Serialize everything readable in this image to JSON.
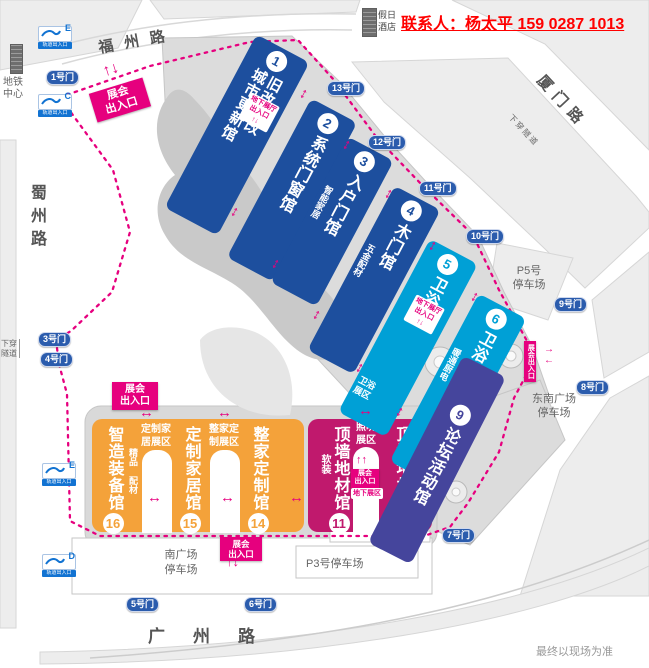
{
  "header": {
    "contact": "联系人：杨太平 159 0287 1013",
    "hotel_lines": [
      "假日",
      "酒店"
    ],
    "disclaimer": "最终以现场为准"
  },
  "roads": {
    "north": "福州路",
    "east": "厦门路",
    "west": "蜀州路",
    "south": "广州路"
  },
  "map_labels": {
    "metro_center_lines": [
      "地铁",
      "中心"
    ],
    "rail_entrance": "轨道出入口",
    "tunnel": "下穿隧道",
    "tunnel_lines": [
      "下穿",
      "隧道"
    ]
  },
  "metro_entrances": [
    {
      "letter": "E"
    },
    {
      "letter": "C"
    },
    {
      "letter": "E"
    },
    {
      "letter": "D"
    }
  ],
  "gates": {
    "g1": "1号门",
    "g3": "3号门",
    "g4": "4号门",
    "g5": "5号门",
    "g6": "6号门",
    "g7": "7号门",
    "g8": "8号门",
    "g9": "9号门",
    "g10": "10号门",
    "g11": "11号门",
    "g12": "12号门",
    "g13": "13号门"
  },
  "parking": {
    "p5_lines": [
      "P5号",
      "停车场"
    ],
    "southeast_lines": [
      "东南广场",
      "停车场"
    ],
    "south_lines": [
      "南广场",
      "停车场"
    ],
    "p3": "P3号停车场"
  },
  "signs": {
    "expo_lines": [
      "展会",
      "出入口"
    ],
    "expo_vertical": "展会出入口",
    "underground_lines": [
      "地下展厅",
      "出入口"
    ],
    "underground_zone": "地下展区"
  },
  "halls": {
    "h1": {
      "num": "1",
      "cols": [
        "旧改局改",
        "城市更新馆"
      ]
    },
    "h2": {
      "num": "2",
      "name": "系统门窗馆"
    },
    "h3": {
      "num": "3",
      "name": "入户门馆",
      "sub": "智能家居"
    },
    "h4": {
      "num": "4",
      "name": "木门馆",
      "sub": "五金配材"
    },
    "h5": {
      "num": "5",
      "name": "卫浴馆",
      "sub_lines": [
        "卫浴",
        "展区"
      ]
    },
    "h6": {
      "num": "6",
      "name": "卫浴馆",
      "sub": "暖通厨电"
    },
    "h9": {
      "num": "9",
      "name": "论坛活动馆"
    },
    "h10": {
      "num": "10",
      "name": "顶墙地材馆",
      "sub": "新材料"
    },
    "h11": {
      "num": "11",
      "name": "顶墙地材馆",
      "sub": "软装"
    },
    "h14": {
      "num": "14",
      "name": "整家定制馆"
    },
    "h15": {
      "num": "15",
      "name": "定制家居馆"
    },
    "h16": {
      "num": "16",
      "name": "智造装备馆",
      "sub_cols": [
        "精品",
        "配材"
      ]
    }
  },
  "zones": {
    "custom_home_lines": [
      "定制家",
      "居展区"
    ],
    "whole_home_lines": [
      "整家定",
      "制展区"
    ],
    "lighting_lines": [
      "照明",
      "展区"
    ]
  },
  "icons": {
    "arrow_v": "↕",
    "arrow_h": "↔",
    "arrow_ud": "↑↓",
    "arrow_uu": "↑↑",
    "arrow_r": "→",
    "arrow_l": "←"
  },
  "colors": {
    "hall_blue": "#1d4f9e",
    "hall_cyan": "#00a0d6",
    "hall_indigo": "#45459c",
    "hall_magenta": "#c0196d",
    "hall_orange": "#f4a23a",
    "accent_magenta": "#e6007e",
    "gate_blue": "#2b5cad",
    "contact_red": "#ff0000"
  }
}
